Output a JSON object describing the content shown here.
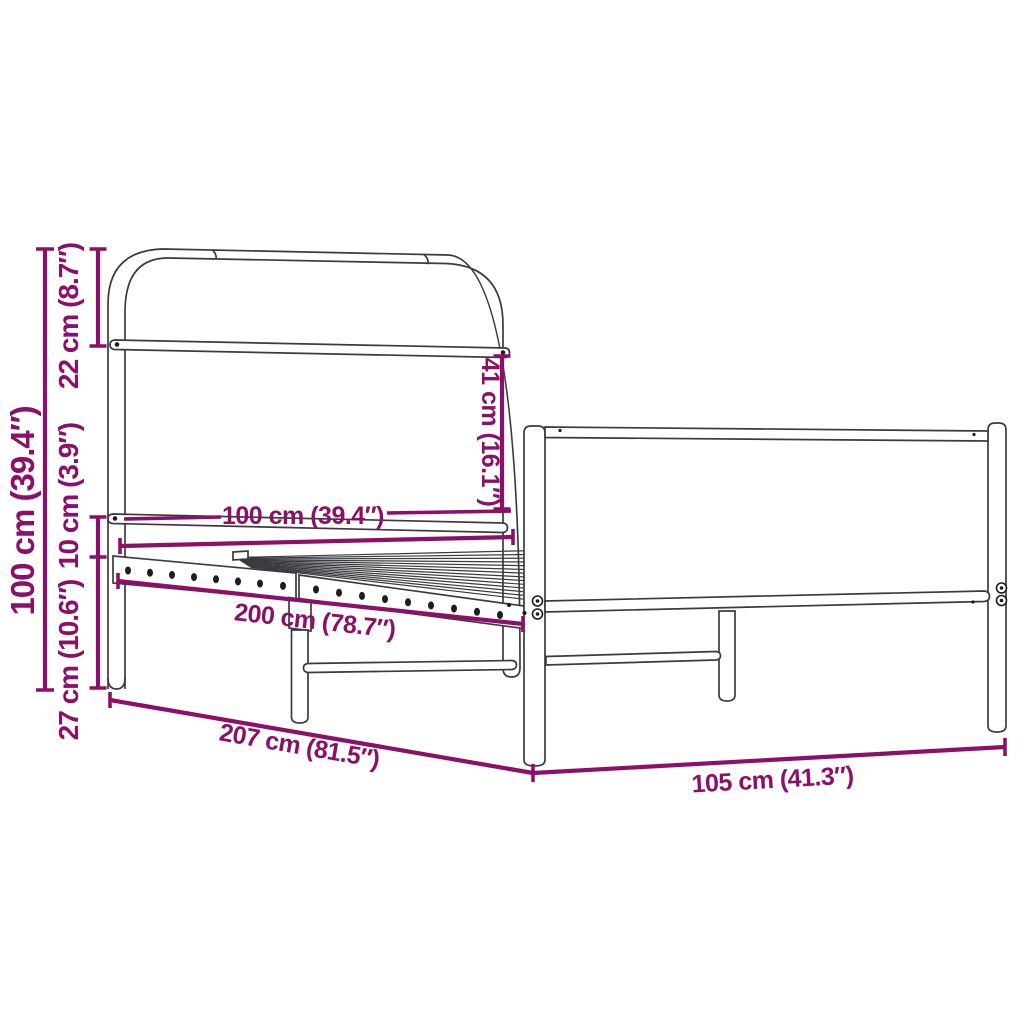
{
  "diagram": {
    "type": "product-dimension-diagram",
    "subject": "metal bed frame without mattress (headboard, footboard, slatted base)",
    "background_color": "#ffffff",
    "accent_color": "#8C1068",
    "outline_color": "#3c3a3e",
    "units": {
      "primary": "cm",
      "secondary": "inches"
    },
    "dimensions": {
      "total_height": {
        "value_cm": 100,
        "value_in": 39.4,
        "label": "100 cm (39.4″)"
      },
      "headboard_top": {
        "value_cm": 22,
        "value_in": 8.7,
        "label": "22 cm (8.7″)"
      },
      "rail_height": {
        "value_cm": 10,
        "value_in": 3.9,
        "label": "10 cm (3.9″)"
      },
      "under_bed_clearance": {
        "value_cm": 27,
        "value_in": 10.6,
        "label": "27 cm (10.6″)"
      },
      "headboard_gap": {
        "value_cm": 41,
        "value_in": 16.1,
        "label": "41 cm (16.1″)"
      },
      "inner_width": {
        "value_cm": 100,
        "value_in": 39.4,
        "label": "100 cm (39.4″)"
      },
      "inner_length": {
        "value_cm": 200,
        "value_in": 78.7,
        "label": "200 cm (78.7″)"
      },
      "total_length": {
        "value_cm": 207,
        "value_in": 81.5,
        "label": "207 cm (81.5″)"
      },
      "total_width": {
        "value_cm": 105,
        "value_in": 41.3,
        "label": "105 cm (41.3″)"
      }
    }
  }
}
